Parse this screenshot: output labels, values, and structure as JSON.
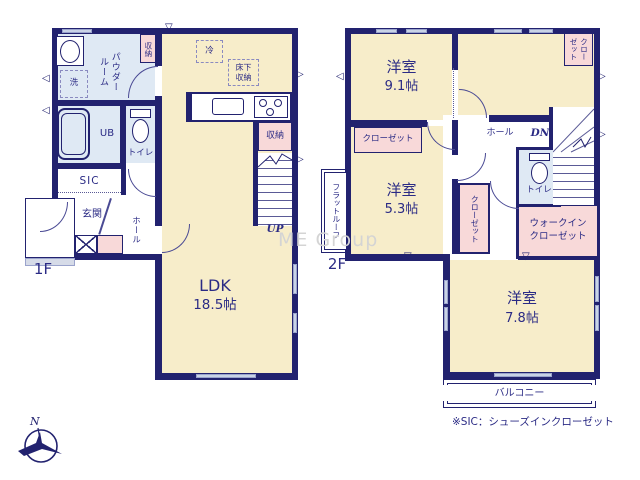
{
  "watermark": "ME Group",
  "footnote": "※SIC：シューズインクローゼット",
  "icons": {
    "triangle_right": "▷",
    "triangle_left": "◁",
    "triangle_down": "▽",
    "compass_north": "N"
  },
  "colors": {
    "wall": "#22226f",
    "room_cream": "#f7edca",
    "wet_area_blue": "#dfe9f4",
    "closet_pink": "#f8d9d9"
  },
  "floor1": {
    "label": "1F",
    "ldk": {
      "name": "LDK",
      "size": "18.5帖"
    },
    "powder_room": "パウダー\nルーム",
    "laundry": "洗",
    "storage_top": "収納",
    "unit_bath": "UB",
    "toilet": "トイレ",
    "sic": "SIC",
    "entrance": "玄関",
    "hall": "ホール",
    "fridge": "冷",
    "underfloor_storage": "床下\n収納",
    "stair_storage": "収納",
    "up": "UP"
  },
  "floor2": {
    "label": "2F",
    "room_a": {
      "name": "洋室",
      "size": "9.1帖"
    },
    "room_b": {
      "name": "洋室",
      "size": "5.3帖"
    },
    "room_c": {
      "name": "洋室",
      "size": "7.8帖"
    },
    "closet_a": "クローゼット",
    "closet_corner": "クロー\nゼット",
    "closet_b": "クローゼット",
    "hall": "ホール",
    "dn": "DN",
    "toilet": "トイレ",
    "walk_in_closet": "ウォークイン\nクローゼット",
    "flat_roof": "フラットルーフ",
    "balcony": "バルコニー"
  }
}
